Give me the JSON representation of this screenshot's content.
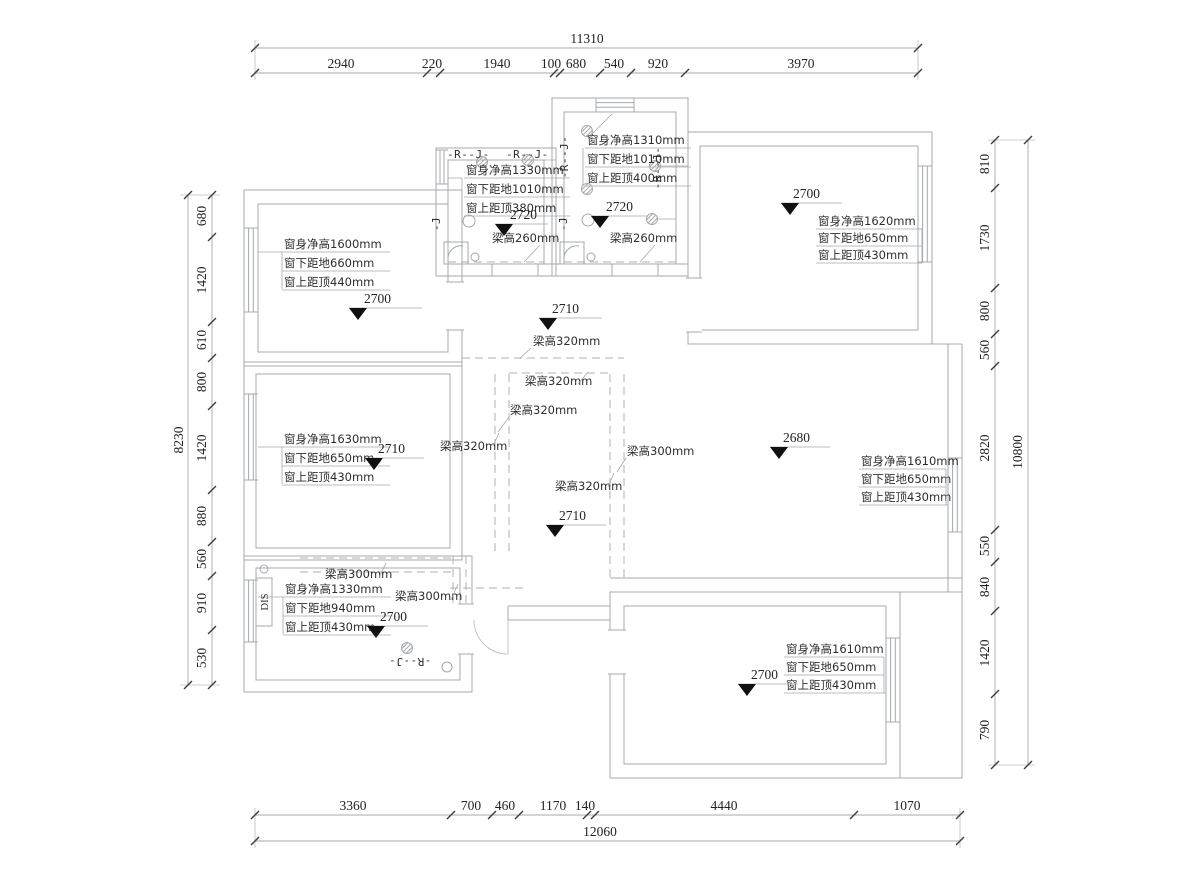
{
  "drawing": {
    "type": "apartment floor plan (original structure survey with ceiling levels, beam heights and window dimensions)"
  },
  "dims": {
    "top": {
      "total": "11310",
      "segments": [
        "2940",
        "220",
        "1940",
        "100",
        "680",
        "540",
        "920",
        "3970"
      ]
    },
    "bottom": {
      "total": "12060",
      "segments": [
        "3360",
        "700",
        "460",
        "1170",
        "140",
        "4440",
        "1070"
      ]
    },
    "left": {
      "total": "8230",
      "segments": [
        "680",
        "1420",
        "610",
        "800",
        "1420",
        "880",
        "560",
        "910",
        "530"
      ]
    },
    "right": {
      "total": "10800",
      "segments": [
        "810",
        "1730",
        "800",
        "560",
        "2820",
        "550",
        "840",
        "1420",
        "790"
      ]
    }
  },
  "levels": {
    "bedroom_top_left": "2700",
    "bath_left": "2720",
    "bath_right": "2720",
    "room_top_right": "2700",
    "hall": "2710",
    "bedroom_mid_left": "2710",
    "living": "2680",
    "corridor": "2710",
    "room_bottom_left": "2700",
    "room_bottom_right": "2700"
  },
  "windows": {
    "bedroom_top_left": [
      "窗身净高1600mm",
      "窗下距地660mm",
      "窗上距顶440mm"
    ],
    "bath_left": [
      "窗身净高1330mm",
      "窗下距地1010mm",
      "窗上距顶380mm"
    ],
    "bath_right": [
      "窗身净高1310mm",
      "窗下距地1010mm",
      "窗上距顶400mm"
    ],
    "room_top_right": [
      "窗身净高1620mm",
      "窗下距地650mm",
      "窗上距顶430mm"
    ],
    "bedroom_mid_left": [
      "窗身净高1630mm",
      "窗下距地650mm",
      "窗上距顶430mm"
    ],
    "living": [
      "窗身净高1610mm",
      "窗下距地650mm",
      "窗上距顶430mm"
    ],
    "room_bottom_left": [
      "窗身净高1330mm",
      "窗下距地940mm",
      "窗上距顶430mm"
    ],
    "room_bottom_right": [
      "窗身净高1610mm",
      "窗下距地650mm",
      "窗上距顶430mm"
    ]
  },
  "beams": {
    "h260": "梁高260mm",
    "h300": "梁高300mm",
    "h320": "梁高320mm"
  },
  "marks": {
    "rj": "-R--J-",
    "rj_short": "-J",
    "dis": "DIS"
  }
}
